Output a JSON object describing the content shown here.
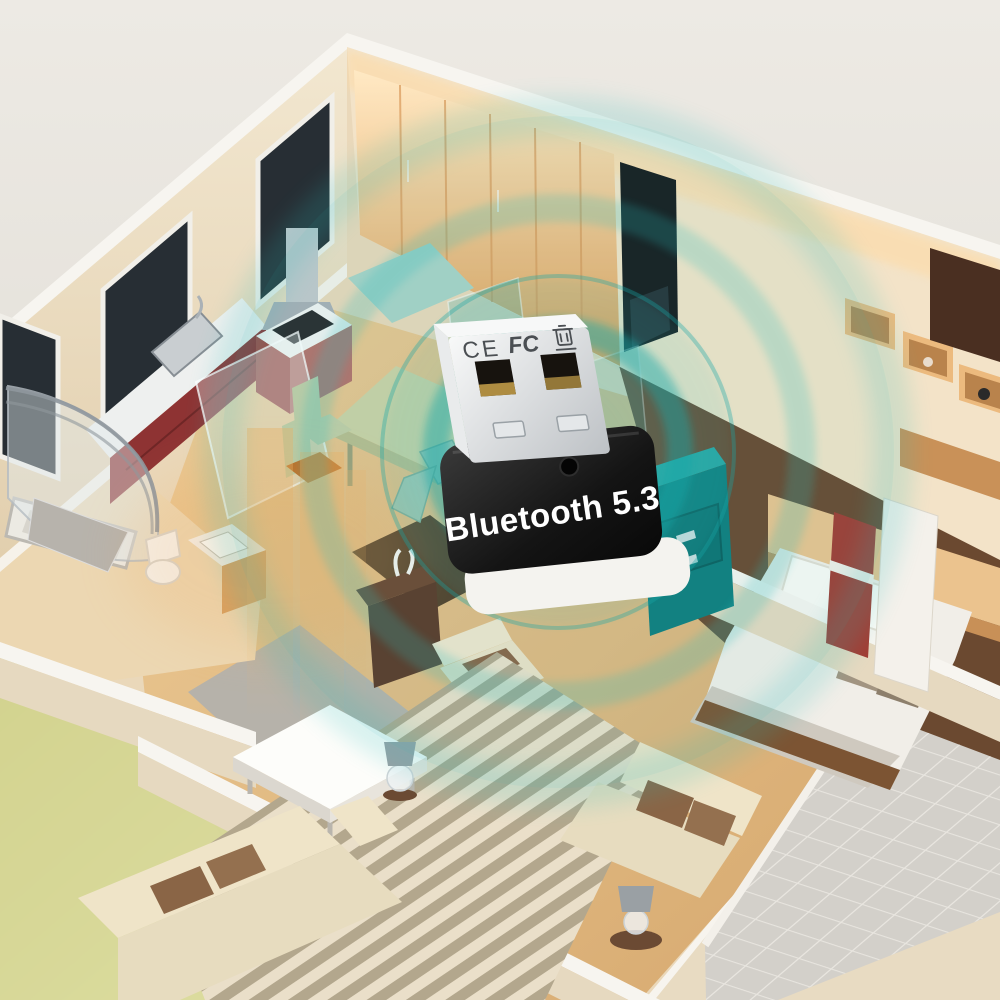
{
  "scene": {
    "kind": "product-hero-render",
    "rooms": [
      "kitchen",
      "dining-area",
      "bathroom",
      "shower",
      "living-room",
      "bedroom",
      "hallway",
      "balcony"
    ],
    "signal": {
      "ring_count": 4,
      "style": "concentric-bluetooth-signal-waves"
    }
  },
  "product": {
    "type": "usb-bluetooth-adapter",
    "label": "Bluetooth 5.3",
    "cert_ce": "CE",
    "cert_fcc": "FC",
    "marks": [
      "ce-mark",
      "fcc-mark",
      "weee-bin-icon",
      "led-indicator"
    ]
  },
  "colors": {
    "bg_top": "#edeae4",
    "bg_bottom": "#d9d5cd",
    "lawn_a": "#cdcd86",
    "lawn_b": "#e3e4ab",
    "shadow": "#6e6e62",
    "wall_cream": "#e8dbc2",
    "wall_white": "#f7f5f0",
    "wall_face": "#ead8ba",
    "window_glass": "#272e34",
    "cabinet_red": "#8e3333",
    "wood_dark": "#6b4930",
    "tile": "#d3d0ca",
    "teal": "#2bbcbc",
    "teal_deep": "#17a7a7",
    "orange_beam": "#f0a85c",
    "rug_a": "#b3a78d",
    "rug_b": "#ead",
    "rug_light": "#eadfc9",
    "sofa": "#efe4c8",
    "cushion": "#8a6546",
    "bed_white": "#f1eee8",
    "red_door": "#a23c33",
    "gold": "#c9a24a",
    "print": "#4b4f53",
    "base_white": "#f4f3ef",
    "label": "#ffffff"
  }
}
